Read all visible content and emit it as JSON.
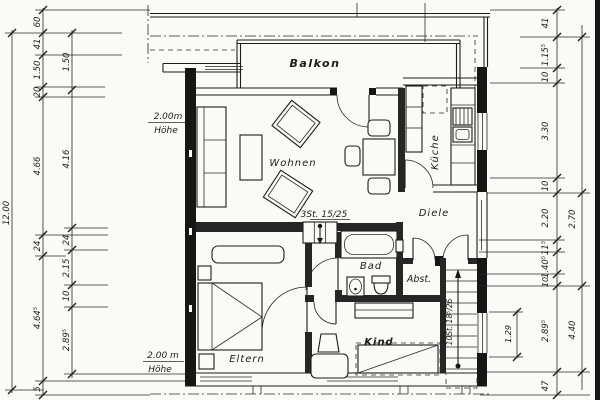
{
  "drawing": {
    "type": "floor-plan",
    "language": "German",
    "ink_color": "#1c1c1c",
    "paper_color": "#fafaf7"
  },
  "rooms": {
    "balkon": "Balkon",
    "wohnen": "Wohnen",
    "kueche": "Küche",
    "diele": "Diele",
    "bad": "Bad",
    "abst": "Abst.",
    "kind": "Kind",
    "eltern": "Eltern"
  },
  "annotations": {
    "height_top_1": "2.00m",
    "height_top_2": "Höhe",
    "height_bottom_1": "2.00 m",
    "height_bottom_2": "Höhe",
    "small_stair": "3St. 15/25",
    "main_stair": "10St. 18⁵/26",
    "stair_width": "1.29"
  },
  "dimensions": {
    "total_height": "12.00",
    "left_outer": [
      "60",
      "41",
      "1.50",
      "20",
      "4.66",
      "24",
      "4.64⁵",
      "5"
    ],
    "left_inner": [
      "1.50",
      "4.16",
      "24",
      "2.15",
      "10",
      "2.89⁵"
    ],
    "right_chain": [
      "41",
      "1.15⁵",
      "10",
      "3.30",
      "10",
      "2.20",
      "11⁵",
      "1.40⁵",
      "10",
      "2.89⁵",
      "47"
    ],
    "right_outer": [
      "2.70",
      "4.40"
    ]
  }
}
